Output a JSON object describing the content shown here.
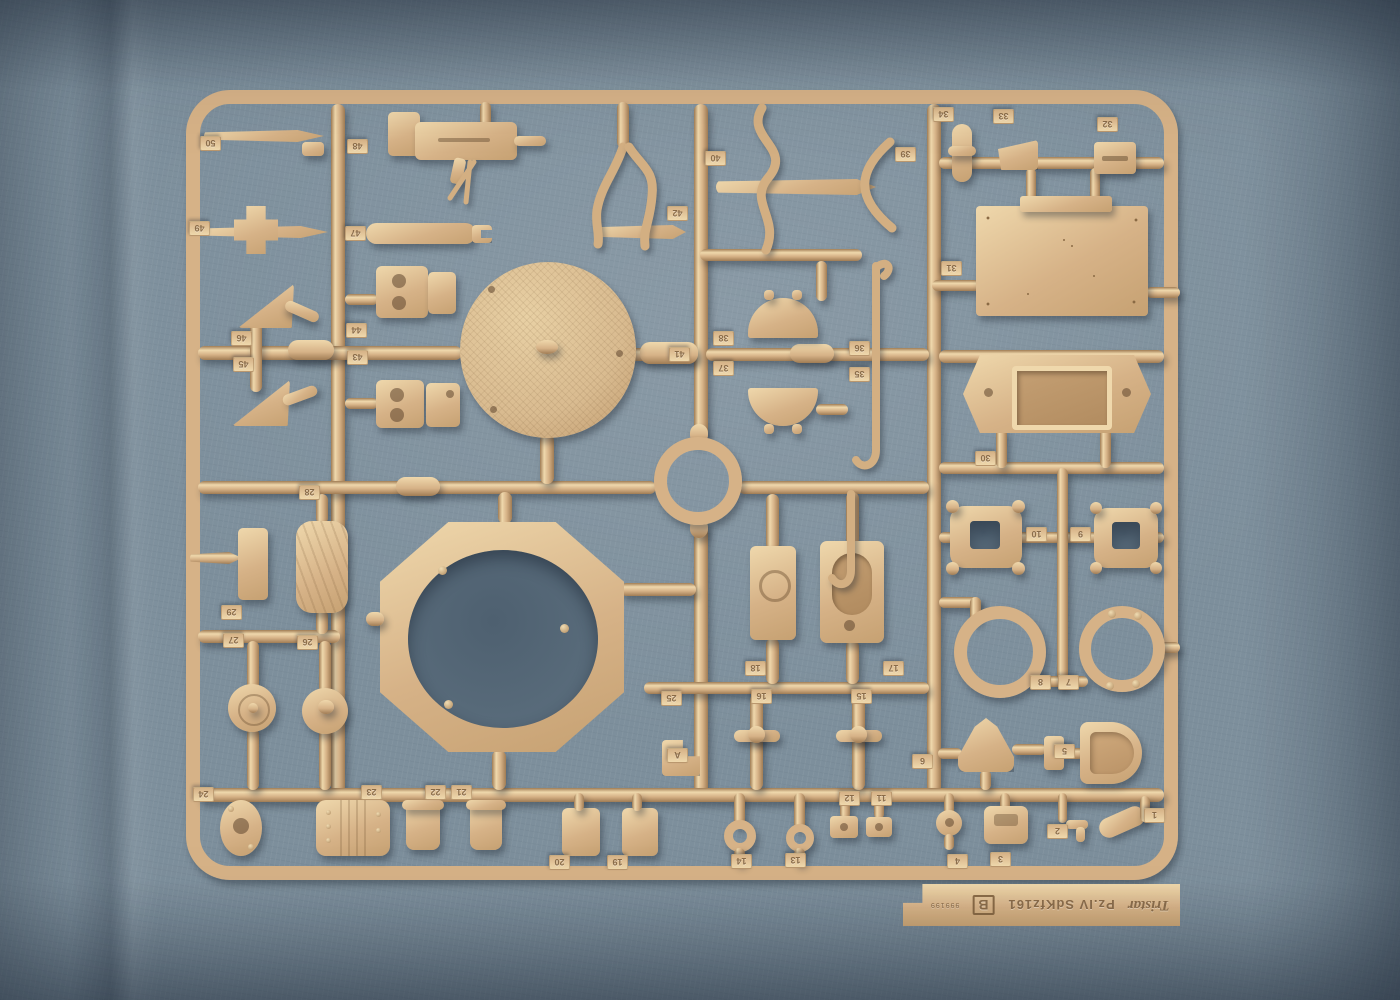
{
  "label_tab": {
    "brand": "Tristar",
    "model": "Pz.IV SdKfz161",
    "sprue_letter": "B",
    "mold_code": "999199"
  },
  "part_tags": [
    "50",
    "49",
    "48",
    "47",
    "46",
    "45",
    "44",
    "43",
    "42",
    "41",
    "40",
    "39",
    "38",
    "37",
    "36",
    "35",
    "34",
    "33",
    "32",
    "31",
    "30",
    "29",
    "28",
    "27",
    "26",
    "25",
    "24",
    "23",
    "22",
    "21",
    "20",
    "19",
    "18",
    "17",
    "16",
    "15",
    "14",
    "13",
    "12",
    "11",
    "10",
    "9",
    "8",
    "7",
    "6",
    "5",
    "4",
    "3",
    "2",
    "1",
    "A"
  ],
  "colors": {
    "fabric": "#7d8f9c",
    "plastic": "#d6b287",
    "plastic-hi": "#efd8ac",
    "plastic-dk": "#a07c54",
    "hole": "#596b7a"
  }
}
